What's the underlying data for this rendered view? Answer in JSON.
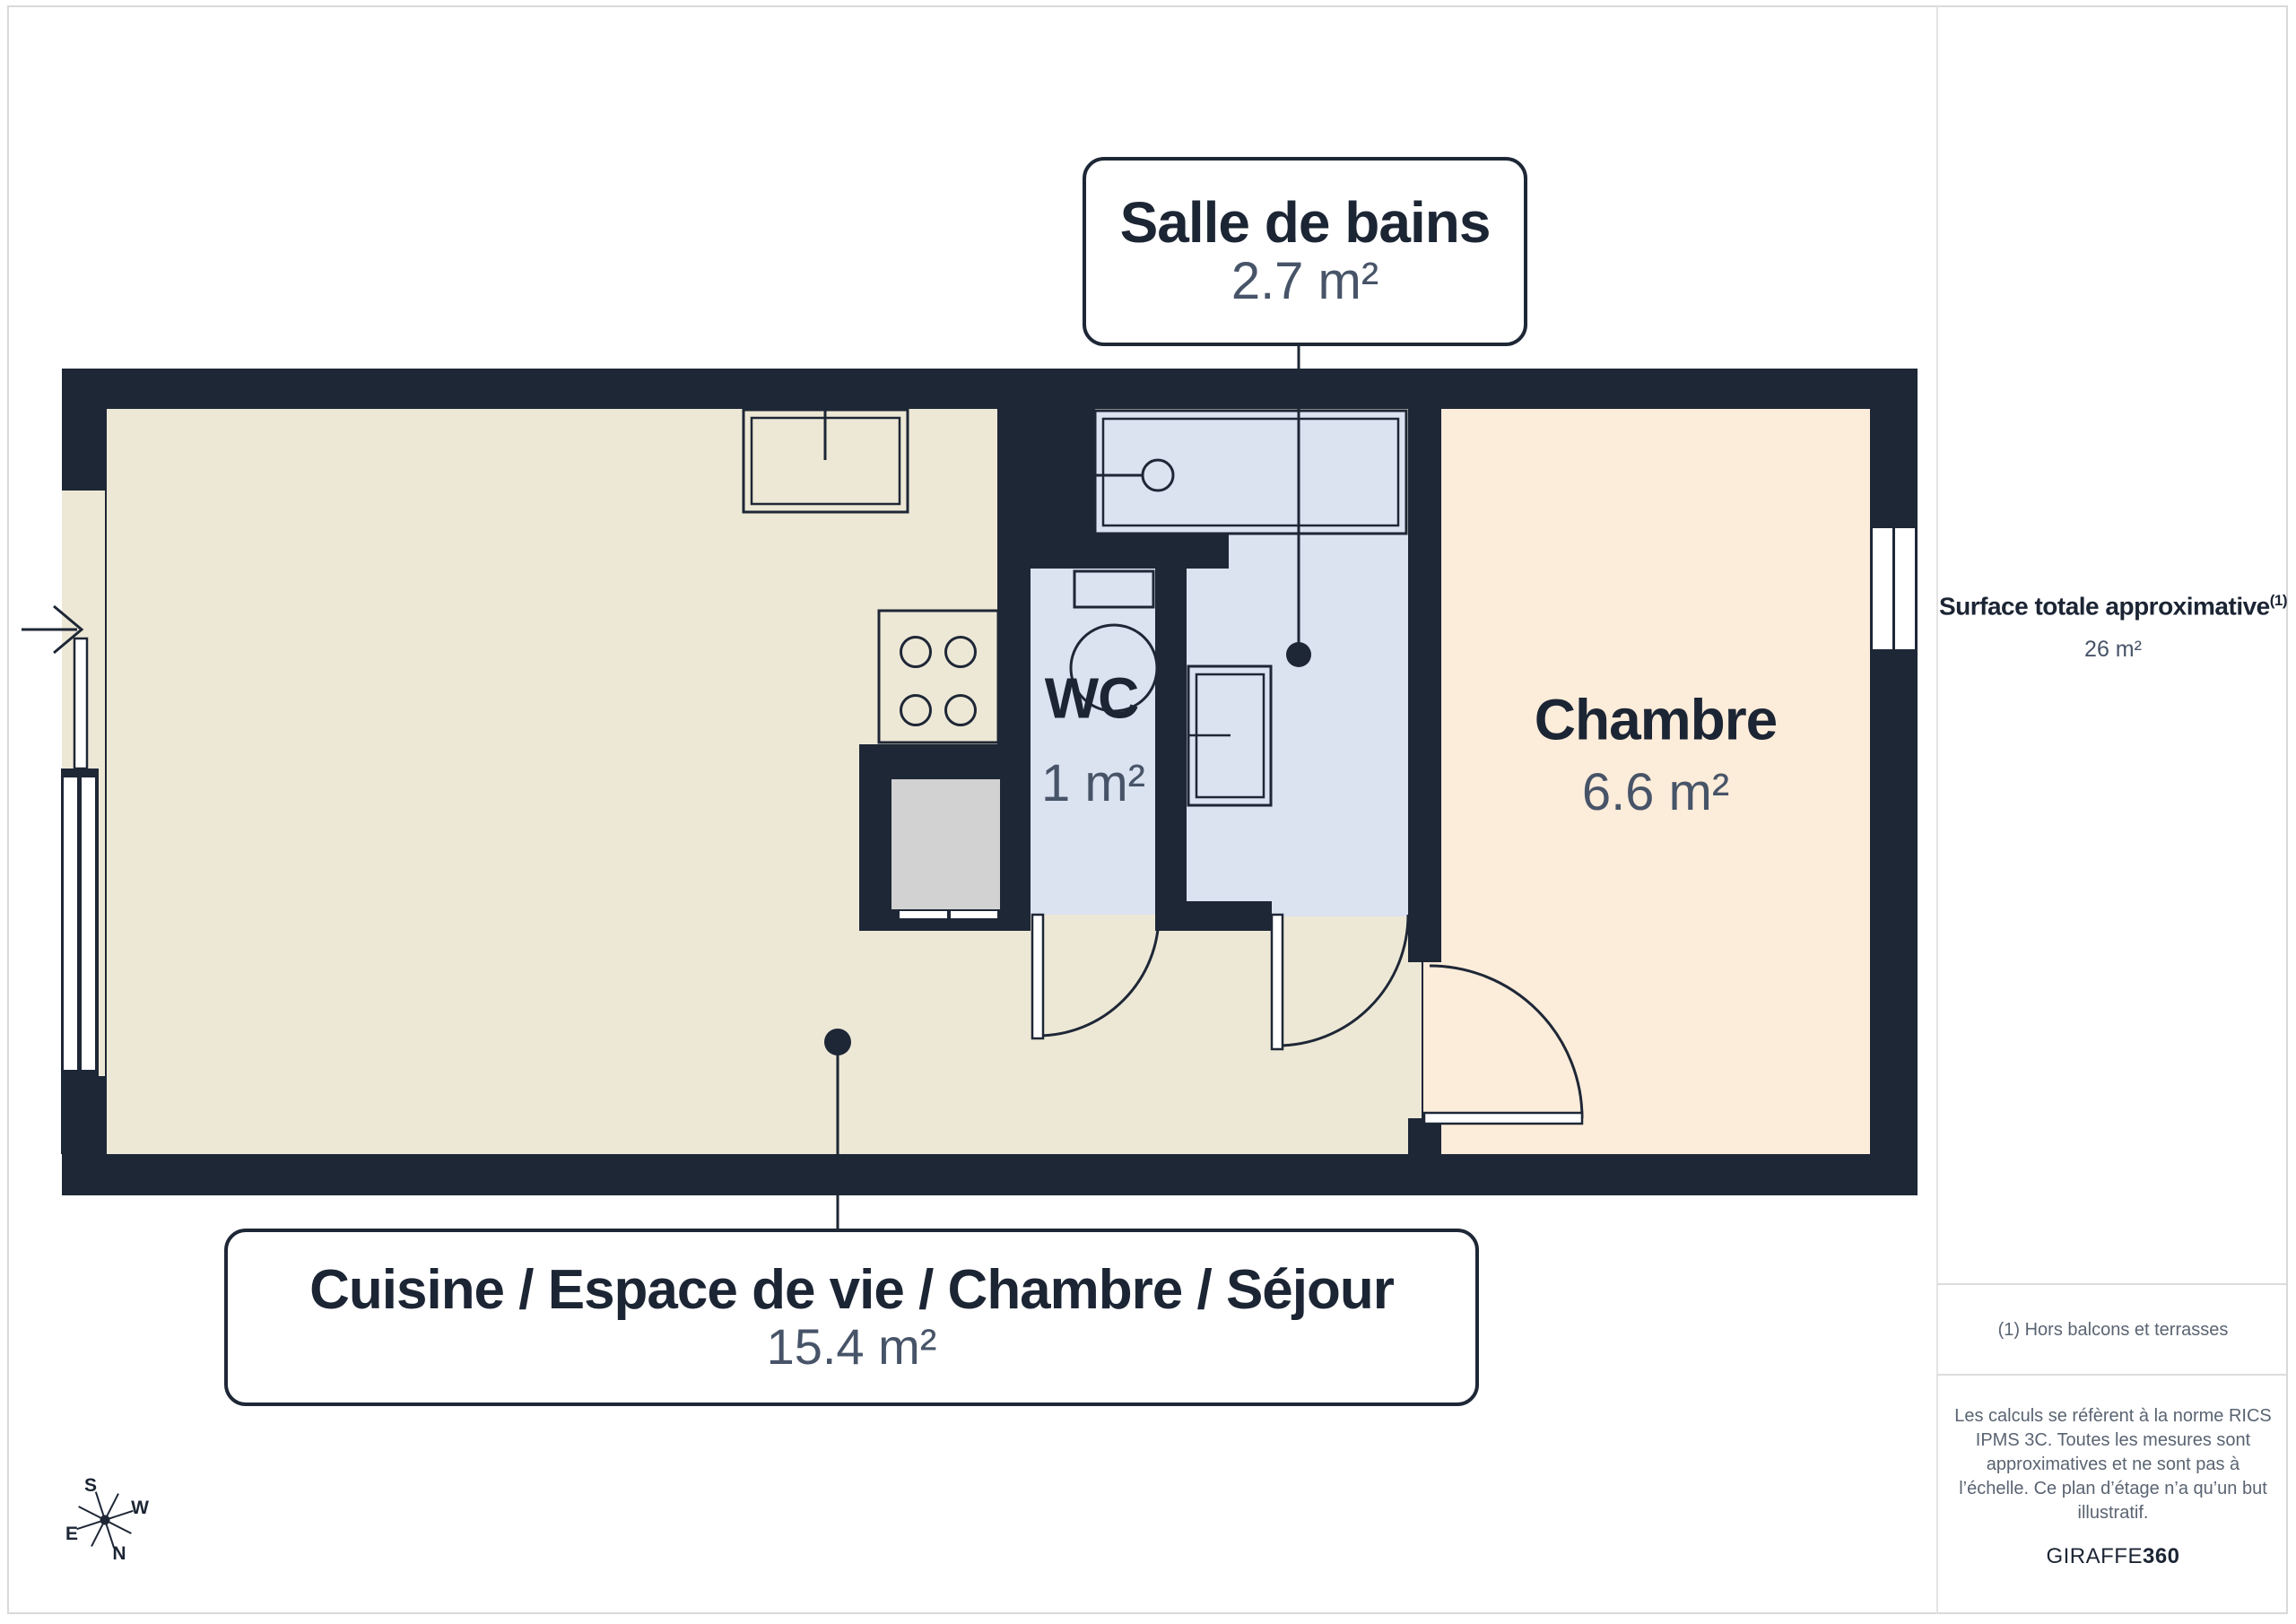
{
  "rooms": {
    "bathroom": {
      "name": "Salle de bains",
      "area": "2.7 m²"
    },
    "wc": {
      "name": "WC",
      "area": "1 m²"
    },
    "bedroom": {
      "name": "Chambre",
      "area": "6.6 m²"
    },
    "living": {
      "name": "Cuisine / Espace de vie / Chambre / Séjour",
      "area": "15.4 m²"
    }
  },
  "sidebar": {
    "total_label": "Surface totale approximative",
    "total_superscript": "(1)",
    "total_value": "26 m²",
    "footnote": "(1) Hors balcons et terrasses",
    "disclaimer": "Les calculs se réfèrent à la norme RICS IPMS 3C. Toutes les mesures sont approximatives et ne sont pas à l’échelle. Ce plan d’étage n’a qu’un but illustratif.",
    "brand_regular": "GIRAFFE",
    "brand_bold": "360"
  },
  "compass": {
    "s": "S",
    "w": "W",
    "e": "E",
    "n": "N"
  },
  "colors": {
    "wall": "#1E2736",
    "ink": "#1C2534",
    "muted": "#475468",
    "foot": "#5A6472",
    "floor_main": "#EDE8D6",
    "floor_bedroom": "#FCECDA",
    "floor_wet": "#DBE2F0",
    "closet_gray": "#D2D2D2"
  }
}
